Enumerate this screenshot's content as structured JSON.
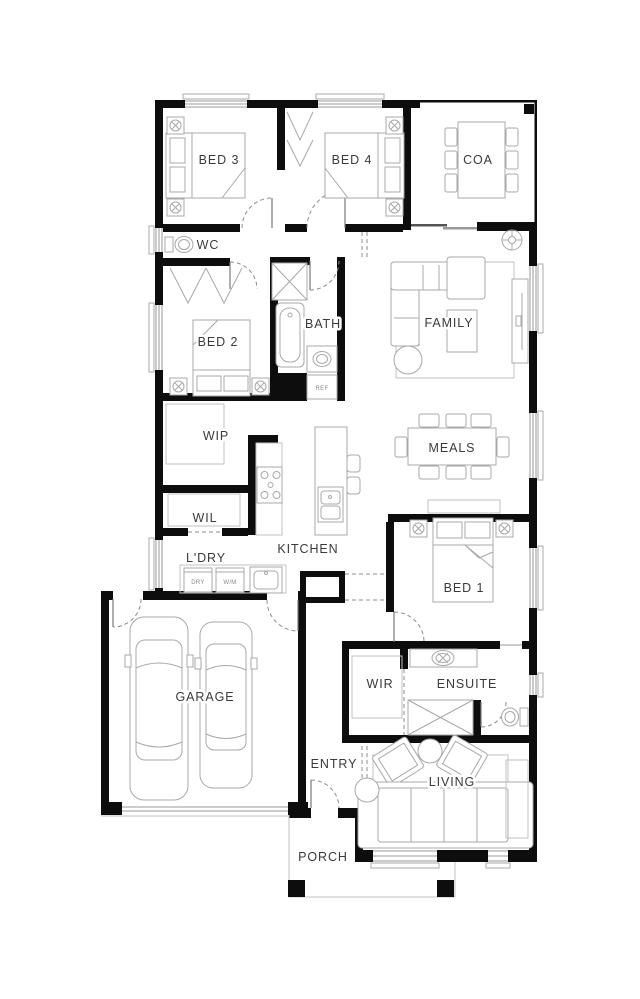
{
  "plan": {
    "rooms": {
      "bed3": "BED 3",
      "bed4": "BED 4",
      "coa": "COA",
      "wc": "WC",
      "bath": "BATH",
      "family": "FAMILY",
      "bed2": "BED 2",
      "wip": "WIP",
      "meals": "MEALS",
      "wil": "WIL",
      "ldry": "L'DRY",
      "kitchen": "KITCHEN",
      "bed1": "BED 1",
      "garage": "GARAGE",
      "wir": "WIR",
      "ensuite": "ENSUITE",
      "entry": "ENTRY",
      "living": "LIVING",
      "porch": "PORCH"
    },
    "appliances": {
      "dryer": "DRY",
      "washer": "W/M",
      "fridge": "REF"
    },
    "colors": {
      "wall": "#0d0d0d",
      "furniture": "#a8a8a8",
      "label": "#3a3a3a",
      "background": "#ffffff"
    }
  }
}
